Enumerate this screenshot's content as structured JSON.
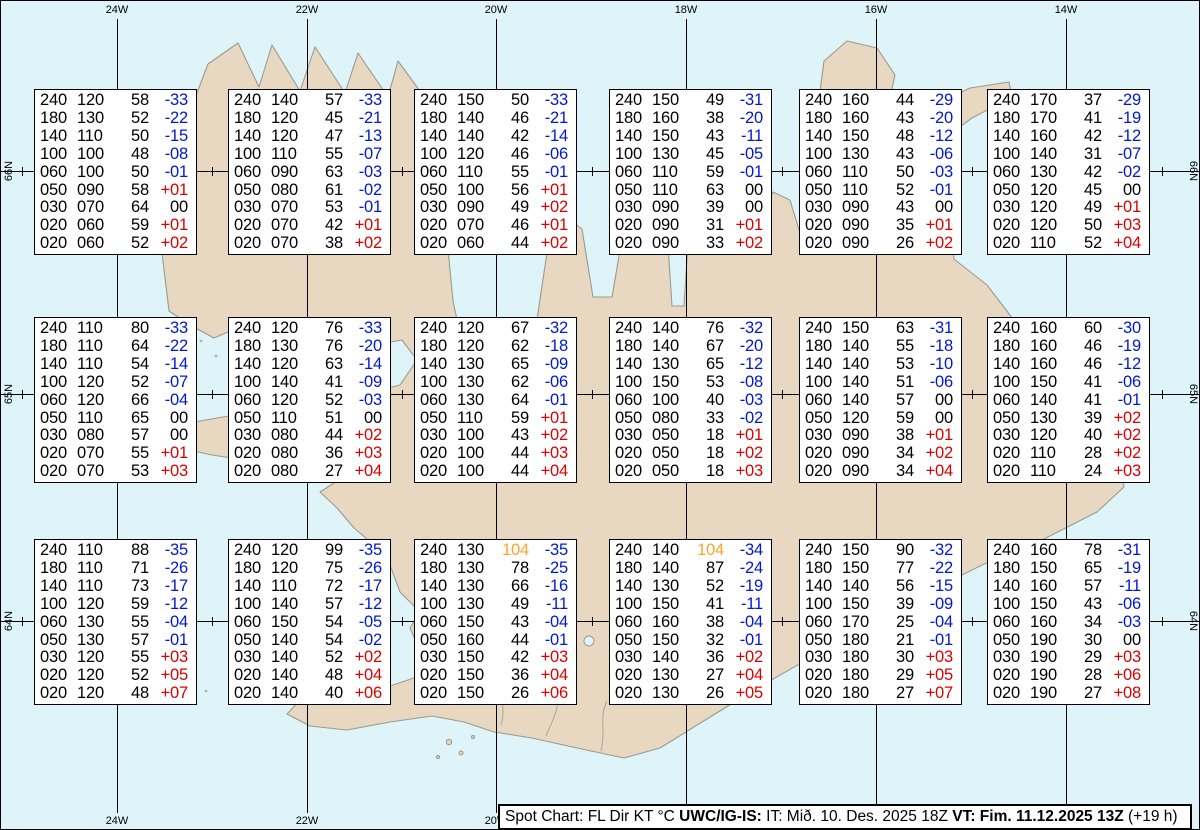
{
  "title": "Spot Chart",
  "colors": {
    "sea": "#def4f9",
    "land": "#e8d8c2",
    "coastline": "#9b9b8e",
    "grid": "#000000",
    "temp_negative": "#0018d4",
    "temp_positive": "#dd0000",
    "wind_high": "#ffa425",
    "box_background": "#ffffff"
  },
  "grid": {
    "meridians": [
      {
        "label": "24W",
        "x": 116
      },
      {
        "label": "22W",
        "x": 306
      },
      {
        "label": "20W",
        "x": 495
      },
      {
        "label": "18W",
        "x": 685
      },
      {
        "label": "16W",
        "x": 875
      },
      {
        "label": "14W",
        "x": 1065
      }
    ],
    "parallels": [
      {
        "label": "66N",
        "y": 170
      },
      {
        "label": "65N",
        "y": 393
      },
      {
        "label": "64N",
        "y": 620
      }
    ],
    "minor_tick_xs": [
      21,
      211,
      401,
      591,
      781,
      971,
      1161
    ]
  },
  "columns": [
    "FL",
    "Dir",
    "KT",
    "°C"
  ],
  "boxes": [
    {
      "id": "box-1",
      "row": 0,
      "col": 0,
      "rows": [
        [
          "240",
          "120",
          "58",
          "-33"
        ],
        [
          "180",
          "130",
          "52",
          "-22"
        ],
        [
          "140",
          "110",
          "50",
          "-15"
        ],
        [
          "100",
          "100",
          "48",
          "-08"
        ],
        [
          "060",
          "100",
          "50",
          "-01"
        ],
        [
          "050",
          "090",
          "58",
          "+01"
        ],
        [
          "030",
          "070",
          "64",
          "00"
        ],
        [
          "020",
          "060",
          "59",
          "+01"
        ],
        [
          "020",
          "060",
          "52",
          "+02"
        ]
      ]
    },
    {
      "id": "box-2",
      "row": 0,
      "col": 1,
      "rows": [
        [
          "240",
          "140",
          "57",
          "-33"
        ],
        [
          "180",
          "120",
          "45",
          "-21"
        ],
        [
          "140",
          "120",
          "47",
          "-13"
        ],
        [
          "100",
          "110",
          "55",
          "-07"
        ],
        [
          "060",
          "090",
          "63",
          "-03"
        ],
        [
          "050",
          "080",
          "61",
          "-02"
        ],
        [
          "030",
          "070",
          "53",
          "-01"
        ],
        [
          "020",
          "070",
          "42",
          "+01"
        ],
        [
          "020",
          "070",
          "38",
          "+02"
        ]
      ]
    },
    {
      "id": "box-3",
      "row": 0,
      "col": 2,
      "rows": [
        [
          "240",
          "150",
          "50",
          "-33"
        ],
        [
          "180",
          "140",
          "46",
          "-21"
        ],
        [
          "140",
          "140",
          "42",
          "-14"
        ],
        [
          "100",
          "120",
          "46",
          "-06"
        ],
        [
          "060",
          "110",
          "55",
          "-01"
        ],
        [
          "050",
          "100",
          "56",
          "+01"
        ],
        [
          "030",
          "090",
          "49",
          "+02"
        ],
        [
          "020",
          "070",
          "46",
          "+01"
        ],
        [
          "020",
          "060",
          "44",
          "+02"
        ]
      ]
    },
    {
      "id": "box-4",
      "row": 0,
      "col": 3,
      "rows": [
        [
          "240",
          "150",
          "49",
          "-31"
        ],
        [
          "180",
          "160",
          "38",
          "-20"
        ],
        [
          "140",
          "150",
          "43",
          "-11"
        ],
        [
          "100",
          "130",
          "45",
          "-05"
        ],
        [
          "060",
          "110",
          "59",
          "-01"
        ],
        [
          "050",
          "110",
          "63",
          "00"
        ],
        [
          "030",
          "090",
          "39",
          "00"
        ],
        [
          "020",
          "090",
          "31",
          "+01"
        ],
        [
          "020",
          "090",
          "33",
          "+02"
        ]
      ]
    },
    {
      "id": "box-5",
      "row": 0,
      "col": 4,
      "rows": [
        [
          "240",
          "160",
          "44",
          "-29"
        ],
        [
          "180",
          "160",
          "43",
          "-20"
        ],
        [
          "140",
          "150",
          "48",
          "-12"
        ],
        [
          "100",
          "130",
          "43",
          "-06"
        ],
        [
          "060",
          "110",
          "50",
          "-03"
        ],
        [
          "050",
          "110",
          "52",
          "-01"
        ],
        [
          "030",
          "090",
          "43",
          "00"
        ],
        [
          "020",
          "090",
          "35",
          "+01"
        ],
        [
          "020",
          "090",
          "26",
          "+02"
        ]
      ]
    },
    {
      "id": "box-6",
      "row": 0,
      "col": 5,
      "rows": [
        [
          "240",
          "170",
          "37",
          "-29"
        ],
        [
          "180",
          "170",
          "41",
          "-19"
        ],
        [
          "140",
          "160",
          "42",
          "-12"
        ],
        [
          "100",
          "140",
          "31",
          "-07"
        ],
        [
          "060",
          "130",
          "42",
          "-02"
        ],
        [
          "050",
          "120",
          "45",
          "00"
        ],
        [
          "030",
          "120",
          "49",
          "+01"
        ],
        [
          "020",
          "120",
          "50",
          "+03"
        ],
        [
          "020",
          "110",
          "52",
          "+04"
        ]
      ]
    },
    {
      "id": "box-7",
      "row": 1,
      "col": 0,
      "rows": [
        [
          "240",
          "110",
          "80",
          "-33"
        ],
        [
          "180",
          "110",
          "64",
          "-22"
        ],
        [
          "140",
          "110",
          "54",
          "-14"
        ],
        [
          "100",
          "120",
          "52",
          "-07"
        ],
        [
          "060",
          "120",
          "66",
          "-04"
        ],
        [
          "050",
          "110",
          "65",
          "00"
        ],
        [
          "030",
          "080",
          "57",
          "00"
        ],
        [
          "020",
          "070",
          "55",
          "+01"
        ],
        [
          "020",
          "070",
          "53",
          "+03"
        ]
      ]
    },
    {
      "id": "box-8",
      "row": 1,
      "col": 1,
      "rows": [
        [
          "240",
          "120",
          "76",
          "-33"
        ],
        [
          "180",
          "130",
          "76",
          "-20"
        ],
        [
          "140",
          "120",
          "63",
          "-14"
        ],
        [
          "100",
          "140",
          "41",
          "-09"
        ],
        [
          "060",
          "120",
          "52",
          "-03"
        ],
        [
          "050",
          "110",
          "51",
          "00"
        ],
        [
          "030",
          "080",
          "44",
          "+02"
        ],
        [
          "020",
          "080",
          "36",
          "+03"
        ],
        [
          "020",
          "080",
          "27",
          "+04"
        ]
      ]
    },
    {
      "id": "box-9",
      "row": 1,
      "col": 2,
      "rows": [
        [
          "240",
          "120",
          "67",
          "-32"
        ],
        [
          "180",
          "120",
          "62",
          "-18"
        ],
        [
          "140",
          "130",
          "65",
          "-09"
        ],
        [
          "100",
          "130",
          "62",
          "-06"
        ],
        [
          "060",
          "130",
          "64",
          "-01"
        ],
        [
          "050",
          "110",
          "59",
          "+01"
        ],
        [
          "030",
          "100",
          "43",
          "+02"
        ],
        [
          "020",
          "100",
          "44",
          "+03"
        ],
        [
          "020",
          "100",
          "44",
          "+04"
        ]
      ]
    },
    {
      "id": "box-10",
      "row": 1,
      "col": 3,
      "rows": [
        [
          "240",
          "140",
          "76",
          "-32"
        ],
        [
          "180",
          "140",
          "67",
          "-20"
        ],
        [
          "140",
          "130",
          "65",
          "-12"
        ],
        [
          "100",
          "150",
          "53",
          "-08"
        ],
        [
          "060",
          "100",
          "40",
          "-03"
        ],
        [
          "050",
          "080",
          "33",
          "-02"
        ],
        [
          "030",
          "050",
          "18",
          "+01"
        ],
        [
          "020",
          "050",
          "18",
          "+02"
        ],
        [
          "020",
          "050",
          "18",
          "+03"
        ]
      ]
    },
    {
      "id": "box-11",
      "row": 1,
      "col": 4,
      "rows": [
        [
          "240",
          "150",
          "63",
          "-31"
        ],
        [
          "180",
          "140",
          "55",
          "-18"
        ],
        [
          "140",
          "140",
          "53",
          "-10"
        ],
        [
          "100",
          "140",
          "51",
          "-06"
        ],
        [
          "060",
          "140",
          "57",
          "00"
        ],
        [
          "050",
          "120",
          "59",
          "00"
        ],
        [
          "030",
          "090",
          "38",
          "+01"
        ],
        [
          "020",
          "090",
          "34",
          "+02"
        ],
        [
          "020",
          "090",
          "34",
          "+04"
        ]
      ]
    },
    {
      "id": "box-12",
      "row": 1,
      "col": 5,
      "rows": [
        [
          "240",
          "160",
          "60",
          "-30"
        ],
        [
          "180",
          "160",
          "46",
          "-19"
        ],
        [
          "140",
          "160",
          "46",
          "-12"
        ],
        [
          "100",
          "150",
          "41",
          "-06"
        ],
        [
          "060",
          "140",
          "41",
          "-01"
        ],
        [
          "050",
          "130",
          "39",
          "+02"
        ],
        [
          "030",
          "120",
          "40",
          "+02"
        ],
        [
          "020",
          "110",
          "28",
          "+02"
        ],
        [
          "020",
          "110",
          "24",
          "+03"
        ]
      ]
    },
    {
      "id": "box-13",
      "row": 2,
      "col": 0,
      "rows": [
        [
          "240",
          "110",
          "88",
          "-35"
        ],
        [
          "180",
          "110",
          "71",
          "-26"
        ],
        [
          "140",
          "110",
          "73",
          "-17"
        ],
        [
          "100",
          "120",
          "59",
          "-12"
        ],
        [
          "060",
          "130",
          "55",
          "-04"
        ],
        [
          "050",
          "130",
          "57",
          "-01"
        ],
        [
          "030",
          "120",
          "55",
          "+03"
        ],
        [
          "020",
          "120",
          "52",
          "+05"
        ],
        [
          "020",
          "120",
          "48",
          "+07"
        ]
      ]
    },
    {
      "id": "box-14",
      "row": 2,
      "col": 1,
      "rows": [
        [
          "240",
          "120",
          "99",
          "-35"
        ],
        [
          "180",
          "120",
          "75",
          "-26"
        ],
        [
          "140",
          "110",
          "72",
          "-17"
        ],
        [
          "100",
          "140",
          "57",
          "-12"
        ],
        [
          "060",
          "150",
          "54",
          "-05"
        ],
        [
          "050",
          "140",
          "54",
          "-02"
        ],
        [
          "030",
          "140",
          "52",
          "+02"
        ],
        [
          "020",
          "140",
          "48",
          "+04"
        ],
        [
          "020",
          "140",
          "40",
          "+06"
        ]
      ]
    },
    {
      "id": "box-15",
      "row": 2,
      "col": 2,
      "rows": [
        [
          "240",
          "130",
          "104",
          "-35"
        ],
        [
          "180",
          "130",
          "78",
          "-25"
        ],
        [
          "140",
          "130",
          "66",
          "-16"
        ],
        [
          "100",
          "130",
          "49",
          "-11"
        ],
        [
          "060",
          "150",
          "43",
          "-04"
        ],
        [
          "050",
          "160",
          "44",
          "-01"
        ],
        [
          "030",
          "150",
          "42",
          "+03"
        ],
        [
          "020",
          "150",
          "36",
          "+04"
        ],
        [
          "020",
          "150",
          "26",
          "+06"
        ]
      ]
    },
    {
      "id": "box-16",
      "row": 2,
      "col": 3,
      "rows": [
        [
          "240",
          "140",
          "104",
          "-34"
        ],
        [
          "180",
          "140",
          "87",
          "-24"
        ],
        [
          "140",
          "130",
          "52",
          "-19"
        ],
        [
          "100",
          "150",
          "41",
          "-11"
        ],
        [
          "060",
          "160",
          "38",
          "-04"
        ],
        [
          "050",
          "150",
          "32",
          "-01"
        ],
        [
          "030",
          "140",
          "36",
          "+02"
        ],
        [
          "020",
          "130",
          "27",
          "+04"
        ],
        [
          "020",
          "130",
          "26",
          "+05"
        ]
      ]
    },
    {
      "id": "box-17",
      "row": 2,
      "col": 4,
      "rows": [
        [
          "240",
          "150",
          "90",
          "-32"
        ],
        [
          "180",
          "150",
          "77",
          "-22"
        ],
        [
          "140",
          "140",
          "56",
          "-15"
        ],
        [
          "100",
          "150",
          "39",
          "-09"
        ],
        [
          "060",
          "170",
          "25",
          "-04"
        ],
        [
          "050",
          "180",
          "21",
          "-01"
        ],
        [
          "030",
          "180",
          "30",
          "+03"
        ],
        [
          "020",
          "180",
          "29",
          "+05"
        ],
        [
          "020",
          "180",
          "27",
          "+07"
        ]
      ]
    },
    {
      "id": "box-18",
      "row": 2,
      "col": 5,
      "rows": [
        [
          "240",
          "160",
          "78",
          "-31"
        ],
        [
          "180",
          "150",
          "65",
          "-19"
        ],
        [
          "140",
          "160",
          "57",
          "-11"
        ],
        [
          "100",
          "150",
          "43",
          "-06"
        ],
        [
          "060",
          "160",
          "34",
          "-03"
        ],
        [
          "050",
          "190",
          "30",
          "00"
        ],
        [
          "030",
          "190",
          "29",
          "+03"
        ],
        [
          "020",
          "190",
          "28",
          "+06"
        ],
        [
          "020",
          "190",
          "27",
          "+08"
        ]
      ]
    }
  ],
  "footer": {
    "segments": [
      {
        "text": "Spot Chart: FL Dir KT °C ",
        "bold": false
      },
      {
        "text": "UWC/IG-IS:",
        "bold": true
      },
      {
        "text": " IT: Mið. 10. Des. 2025 18Z ",
        "bold": false
      },
      {
        "text": "VT: Fim. 11.12.2025 13Z",
        "bold": true
      },
      {
        "text": " (+19 h)",
        "bold": false
      }
    ]
  }
}
